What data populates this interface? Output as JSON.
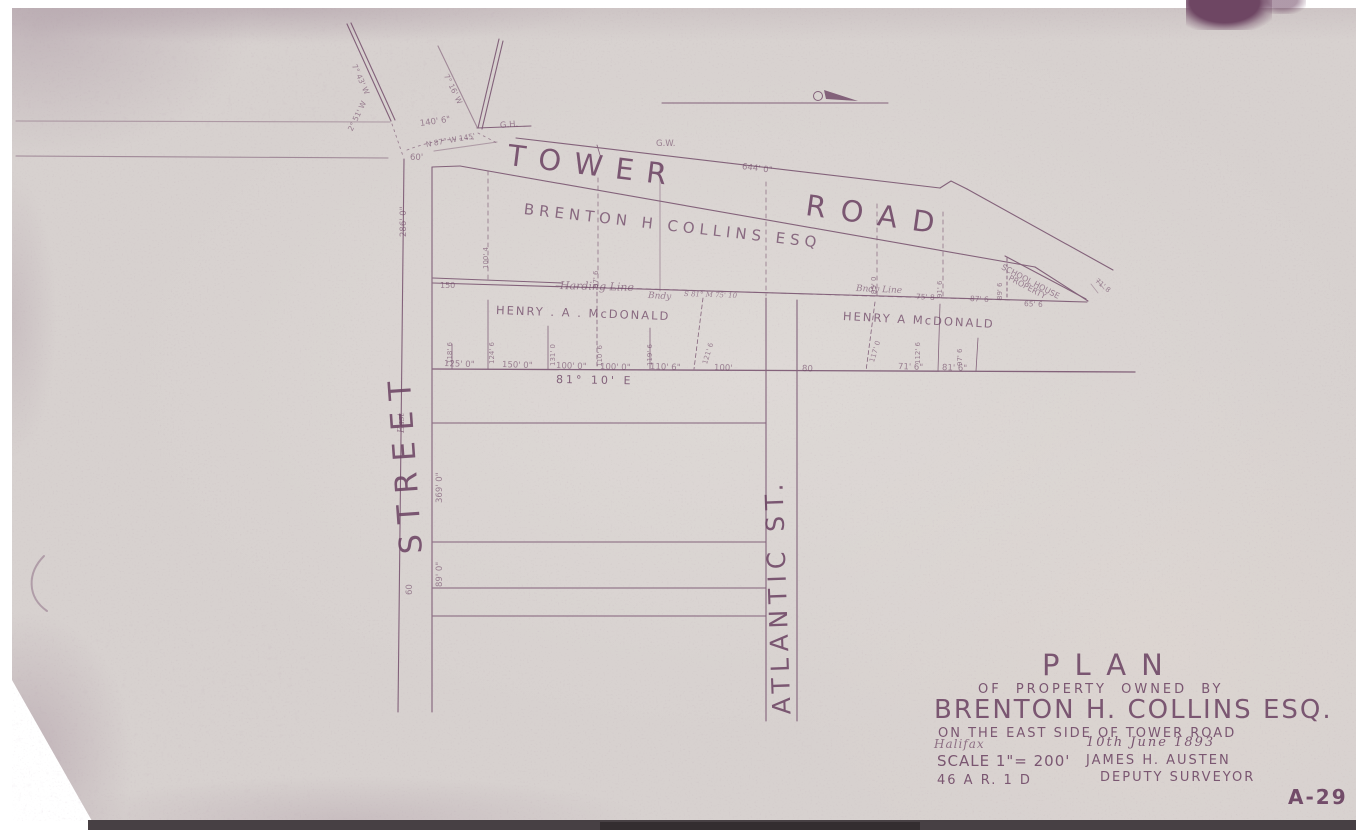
{
  "sheet": {
    "number": "A-29"
  },
  "title_block": {
    "title": "PLAN",
    "line2": "OF PROPERTY OWNED BY",
    "owner": "BRENTON H. COLLINS ESQ.",
    "line4": "ON THE EAST SIDE OF TOWER ROAD",
    "place": "Halifax",
    "date": "10th June 1893",
    "scale": "SCALE 1\"= 200'",
    "surveyor": "JAMES H. AUSTEN",
    "surveyor_title": "DEPUTY SURVEYOR",
    "file_ref": "46 A    R. 1 D"
  },
  "roads": {
    "tower": "TOWER",
    "road": "ROAD",
    "street": "STREET",
    "street_small": "East",
    "atlantic": "ATLANTIC  ST."
  },
  "owners": {
    "collins": "BRENTON   H   COLLINS    ESQ",
    "mcdonald_west": "HENRY . A . McDONALD",
    "mcdonald_east": "HENRY  A  McDONALD",
    "school_house_1": "SCHOOL HOUSE",
    "school_house_2": "PROPERTY"
  },
  "boundary_notes": {
    "harding": "Harding    Line",
    "bndy_west": "Bndy",
    "bndy_bearing": "S 81°  M  75' 10",
    "bndy_east": "Bndy  Line",
    "bearing_south": "81° 10' E"
  },
  "survey_marks": {
    "gh1": "G.H.",
    "gh2": "G.W."
  },
  "dimensions": {
    "street_upper": "286' 0\"",
    "street_mid": "369' 0\"",
    "street_lower": "89' 0\"",
    "street_width": "60",
    "street_top": "60'",
    "intersection": "140' 6\"",
    "intersection_bearing": "N 87° W  145'",
    "diag_west_bearing": "7° 43' W",
    "diag_east_bearing": "7° 16' W",
    "bearing_251": "2° 51' W",
    "road_frontage": "644' 0\"",
    "collins_150": "150",
    "bottom_row": [
      "125' 0\"",
      "150' 0\"",
      "100' 0\"",
      "100' 0\"",
      "110' 6\"",
      "100'",
      "80",
      "71' 6\"",
      "81' 6\""
    ],
    "lot_depths_mcdonald": [
      "118' 6",
      "124' 6",
      "131' 0",
      "110' 6",
      "119' 6",
      "121' 6",
      "117' 0",
      "112' 6",
      "97' 6"
    ],
    "lot_depths_collins": [
      "100' 4",
      "97' 6",
      "95' 0",
      "91' 6",
      "89' 6"
    ],
    "tip_dims": [
      "75' 8",
      "87' 6",
      "65' 6",
      "71' 8"
    ]
  },
  "colors": {
    "paper": "#d7d1cf",
    "ink": "#6d4564",
    "ink_faint": "#8d6c86",
    "scan_background": "#ffffff",
    "scan_strip": "#474044"
  }
}
